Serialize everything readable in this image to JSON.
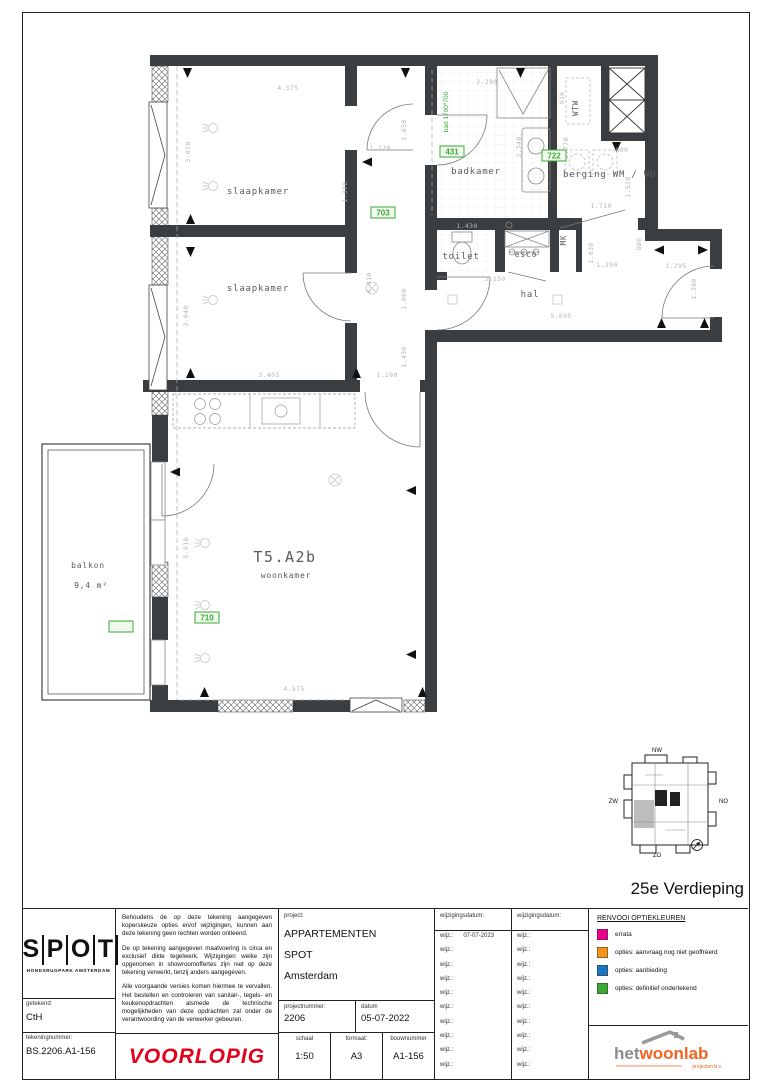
{
  "floor_label": "25e Verdieping",
  "plan": {
    "unit": "T5.A2b",
    "rooms": {
      "slaapkamer1": "slaapkamer",
      "slaapkamer2": "slaapkamer",
      "badkamer": "badkamer",
      "berging": "berging WM / WD",
      "toilet": "toilet",
      "esco": "esco",
      "mk": "MK",
      "wtw": "WTW",
      "hal": "hal",
      "woonkamer": "woonkamer",
      "balkon": "balkon",
      "balkon_area": "9,4 m²"
    },
    "options": {
      "badkamer": "431",
      "berging": "722",
      "corridor": "703",
      "woonkamer": "710",
      "balkon": "765"
    },
    "option_color": "#3aaa35",
    "bad_note": "bad 1700*700",
    "dims": [
      "4.575",
      "3.028",
      "1.170",
      "1.658",
      "1.370",
      "2.290",
      "910",
      "2.748",
      "2.778",
      "800",
      "1.528",
      "1.710",
      "1.430",
      "3.150",
      "1.030",
      "880",
      "1.250",
      "1.295",
      "1.380",
      "5.695",
      "3.405",
      "3.040",
      "4.410",
      "1.060",
      "1.430",
      "1.100",
      "5.918",
      "4.575"
    ]
  },
  "minimap": {
    "nw": "NW",
    "zw": "ZW",
    "no": "NO",
    "zo": "ZO"
  },
  "titleblock": {
    "logo_letters": {
      "l1": "S",
      "l2": "P",
      "l3": "O",
      "l4": "T"
    },
    "logo_subtitle": "HONDSRUGPARK AMSTERDAM",
    "getekend_label": "getekend:",
    "getekend_value": "CtH",
    "tekeningnummer_label": "tekeningnummer:",
    "tekeningnummer_value": "BS.2206.A1-156",
    "voorlopig": "VOORLOPIG",
    "voorlopig_color": "#e2001a",
    "disclaimer1": "Behoudens de op deze tekening aangegeven koperskeuze opties en/of wijzigingen, kunnen aan deze tekening geen rechten worden ontleend.",
    "disclaimer2": "De op tekening aangegeven maatvoering is circa en exclusief dikte tegelwerk. Wijzigingen welke zijn opgenomen in showroomoffertes zijn niet op deze tekening verwerkt, tenzij anders aangegeven.",
    "disclaimer3": "Alle voorgaande versies komen hiermee te vervallen. Het bestellen en controleren van sanitair-, tegels- en keukenopdrachten alsmede de technische mogelijkheden van deze opdrachten zal onder de verantwoording van de verwerker gebeuren.",
    "project_label": "project:",
    "project_line1": "APPARTEMENTEN",
    "project_line2": "SPOT",
    "project_line3": "Amsterdam",
    "projectnummer_label": "projectnummer:",
    "projectnummer_value": "2206",
    "datum_label": "datum",
    "datum_value": "05-07-2022",
    "schaal_label": "schaal",
    "schaal_value": "1:50",
    "formaat_label": "formaat:",
    "formaat_value": "A3",
    "bouwnummer_label": "bouwnummer",
    "bouwnummer_value": "A1-156",
    "wijzigingsdatum_label": "wijzigingsdatum:",
    "wijz_label": "wijz.:",
    "wijz_first_value": "07-07-2023",
    "legend": {
      "title": "RENVOOI OPTIEKLEUREN",
      "items": [
        {
          "color": "#ec008c",
          "label": "errata"
        },
        {
          "color": "#f7941d",
          "label": "opties: aanvraag nog niet geoffreerd"
        },
        {
          "color": "#1c75bc",
          "label": "opties: aanbieding"
        },
        {
          "color": "#3aaa35",
          "label": "opties: definitief ondertekend"
        }
      ]
    },
    "brand": {
      "het": "het",
      "woonlab": "woonlab",
      "sub": "projecten b.v.",
      "orange": "#f26522",
      "gray": "#8c8c8c"
    }
  }
}
